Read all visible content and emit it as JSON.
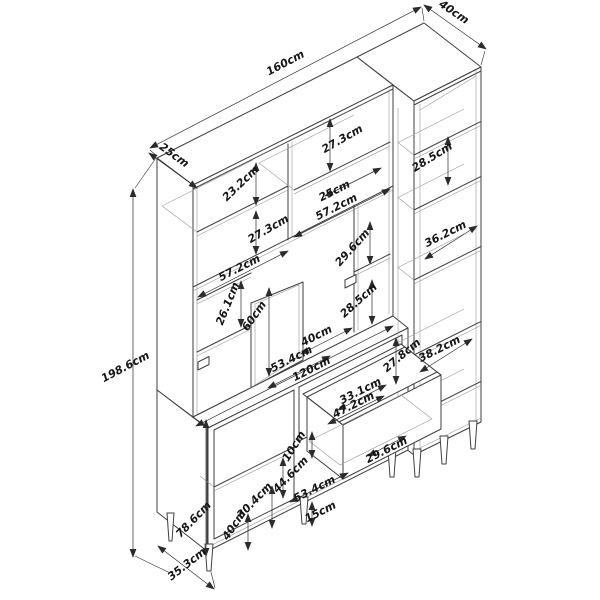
{
  "drawing": {
    "kind": "isometric-furniture-dimension-drawing",
    "units": "cm",
    "background_color": "#ffffff",
    "line_color": "#3f3f3f",
    "label_color": "#161616"
  },
  "dims": {
    "d160": {
      "label": "160cm"
    },
    "d40top": {
      "label": "40cm"
    },
    "d25top": {
      "label": "25cm"
    },
    "d1986": {
      "label": "198.6cm"
    },
    "d232": {
      "label": "23.2cm"
    },
    "d273L": {
      "label": "27.3cm"
    },
    "d572L": {
      "label": "57.2cm"
    },
    "d273R": {
      "label": "27.3cm"
    },
    "d25R": {
      "label": "25cm"
    },
    "d572R": {
      "label": "57.2cm"
    },
    "d261": {
      "label": "26.1cm"
    },
    "d60": {
      "label": "60cm"
    },
    "d296M": {
      "label": "29.6cm"
    },
    "d285M": {
      "label": "28.5cm"
    },
    "d285R": {
      "label": "28.5cm"
    },
    "d362": {
      "label": "36.2cm"
    },
    "d382": {
      "label": "38.2cm"
    },
    "d40mid": {
      "label": "40cm"
    },
    "d534mid": {
      "label": "53.4cm"
    },
    "d120": {
      "label": "120cm"
    },
    "d278": {
      "label": "27.8cm"
    },
    "d331": {
      "label": "33.1cm"
    },
    "d472": {
      "label": "47.2cm"
    },
    "d10": {
      "label": "10cm"
    },
    "d446": {
      "label": "44.6cm"
    },
    "d296D": {
      "label": "29.6cm"
    },
    "d534B": {
      "label": "53.4cm"
    },
    "d15": {
      "label": "15cm"
    },
    "d304": {
      "label": "30.4cm"
    },
    "d40B": {
      "label": "40cm"
    },
    "d786": {
      "label": "78.6cm"
    },
    "d353": {
      "label": "35.3cm"
    }
  }
}
